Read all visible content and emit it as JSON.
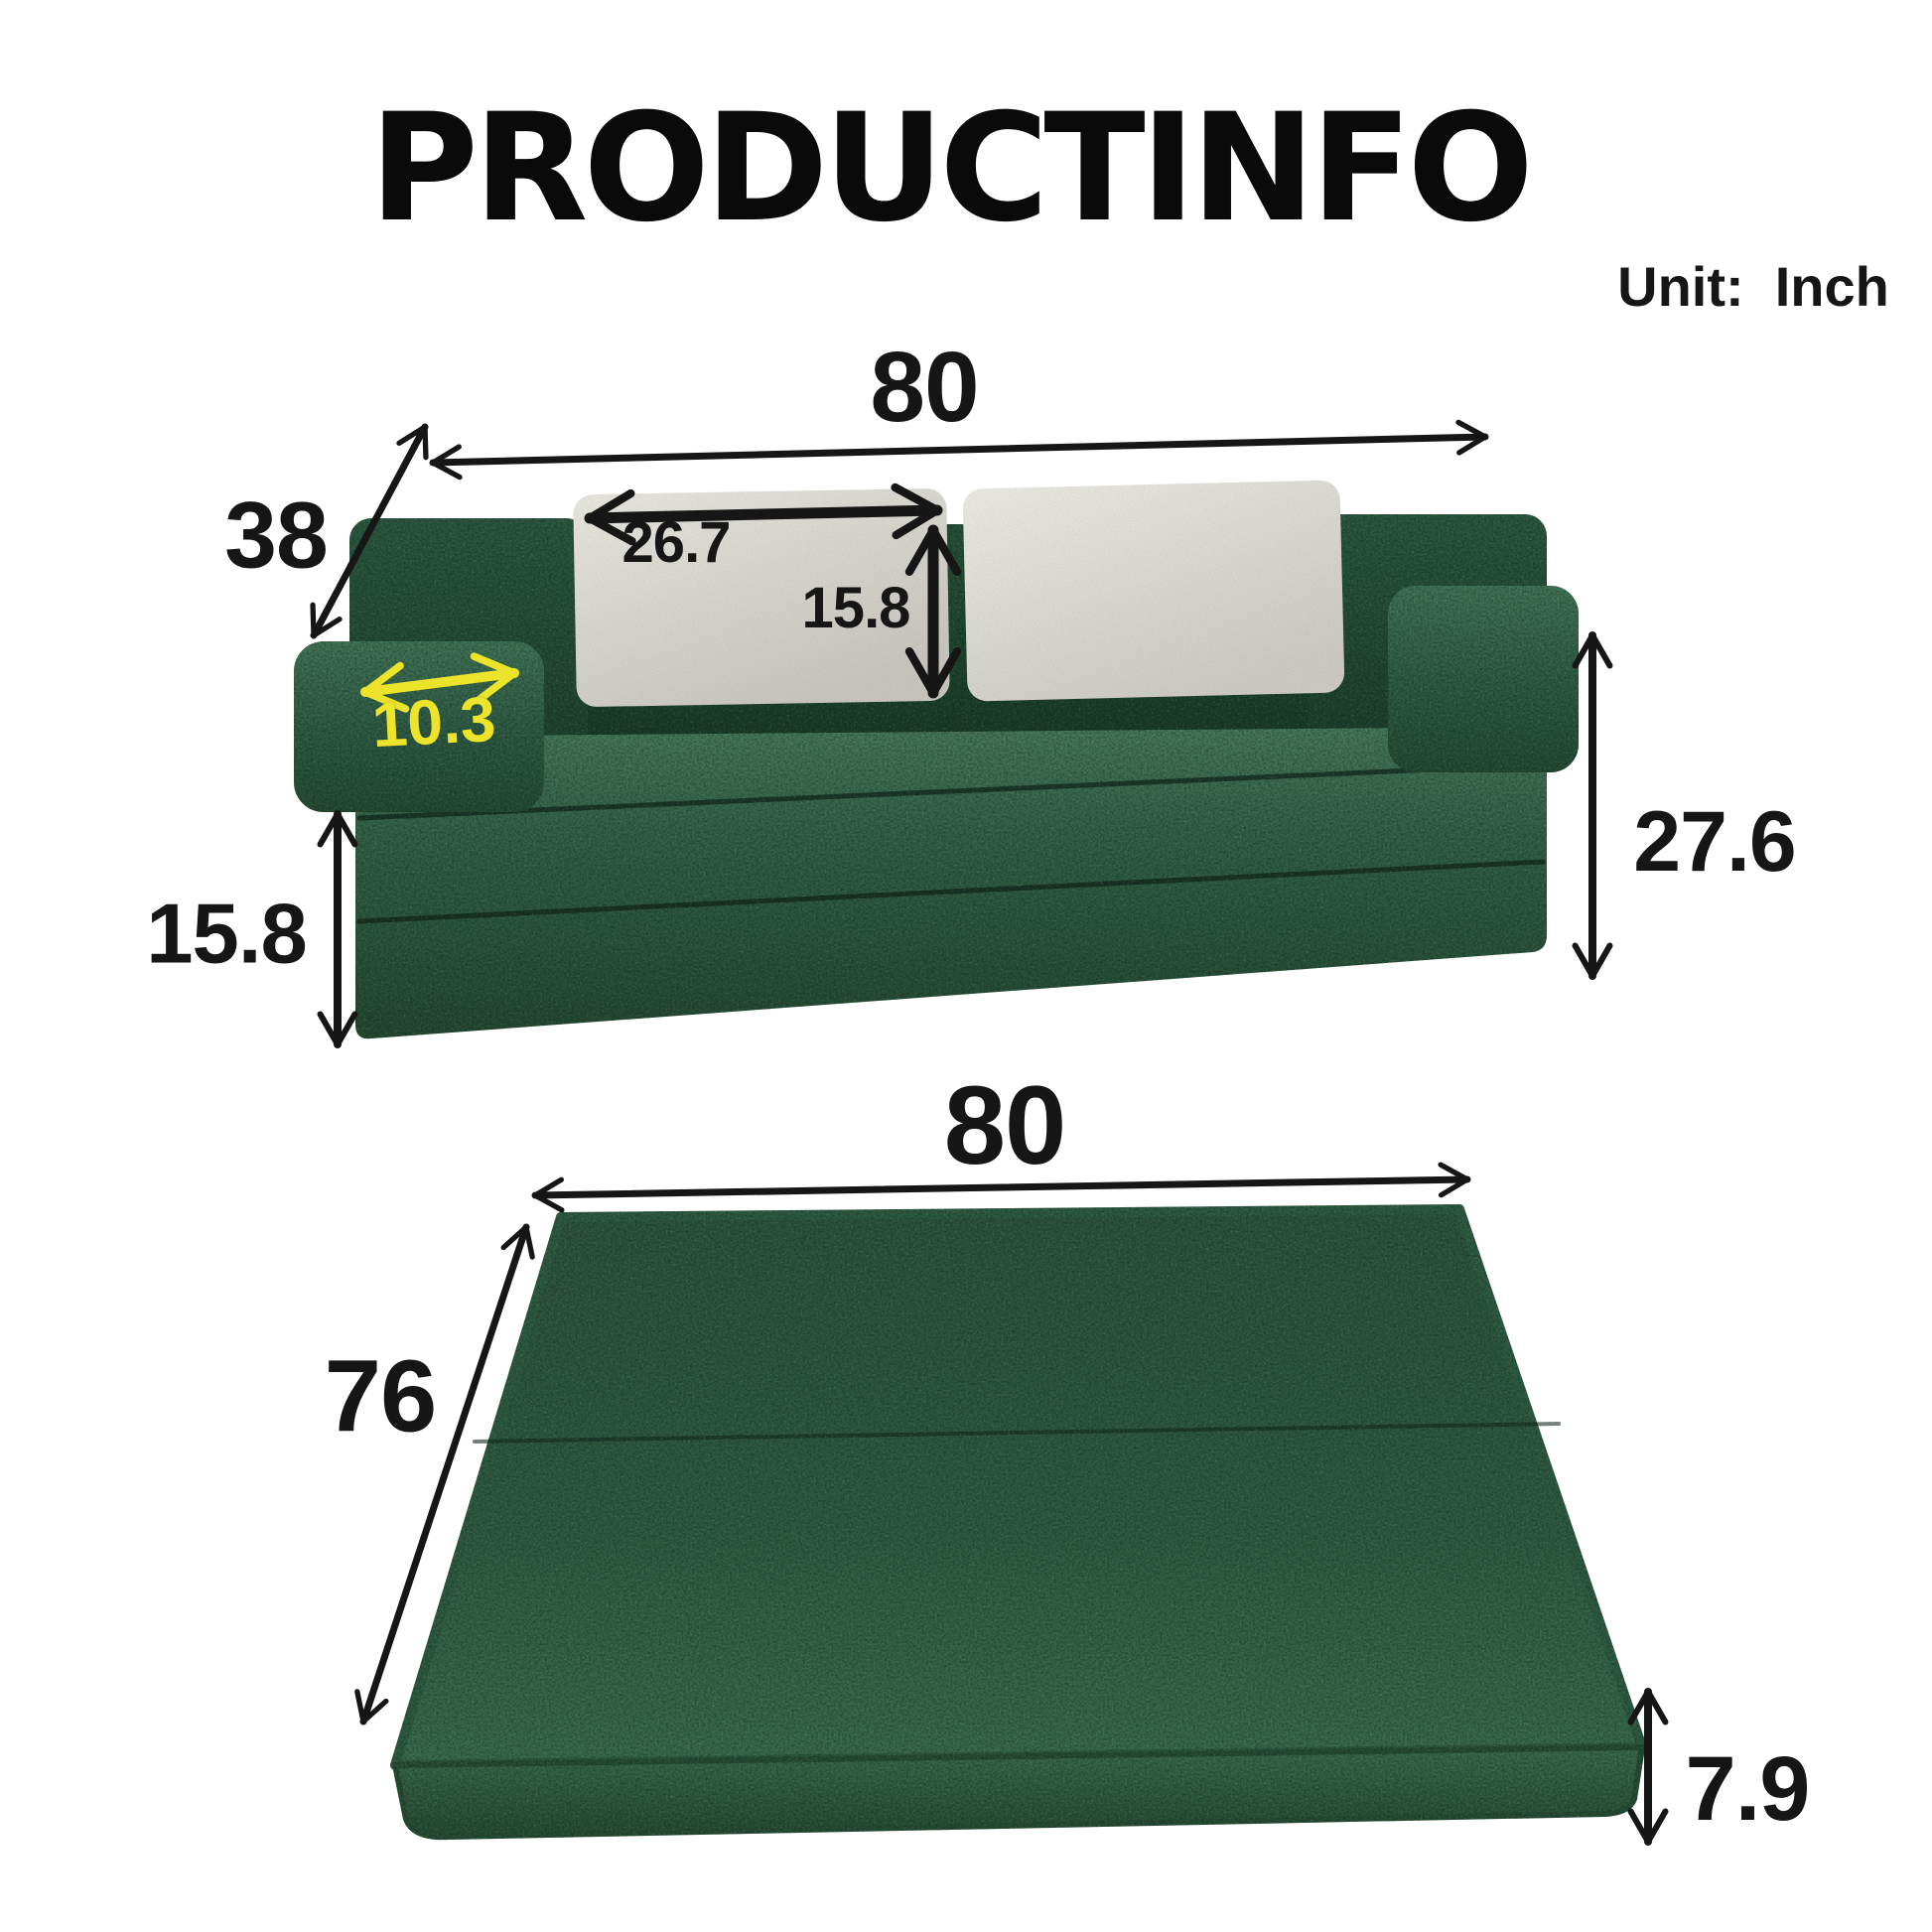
{
  "page": {
    "title": "PRODUCTINFO",
    "unit_note": "Unit:  Inch"
  },
  "sofa_view": {
    "width_in": "80",
    "depth_in": "38",
    "pillow_width_in": "26.7",
    "pillow_height_in": "15.8",
    "armrest_width_in": "10.3",
    "folded_layers_height_in": "15.8",
    "overall_height_in": "27.6"
  },
  "mattress_view": {
    "width_in": "80",
    "length_in": "76",
    "thickness_in": "7.9"
  },
  "colors": {
    "fabric_green": "#2b5440",
    "fabric_green_dark": "#1a3826",
    "pillow_gray": "#dbd9d3",
    "highlight_yellow": "#ece32b",
    "dimension_black": "#161616",
    "background": "#ffffff"
  }
}
